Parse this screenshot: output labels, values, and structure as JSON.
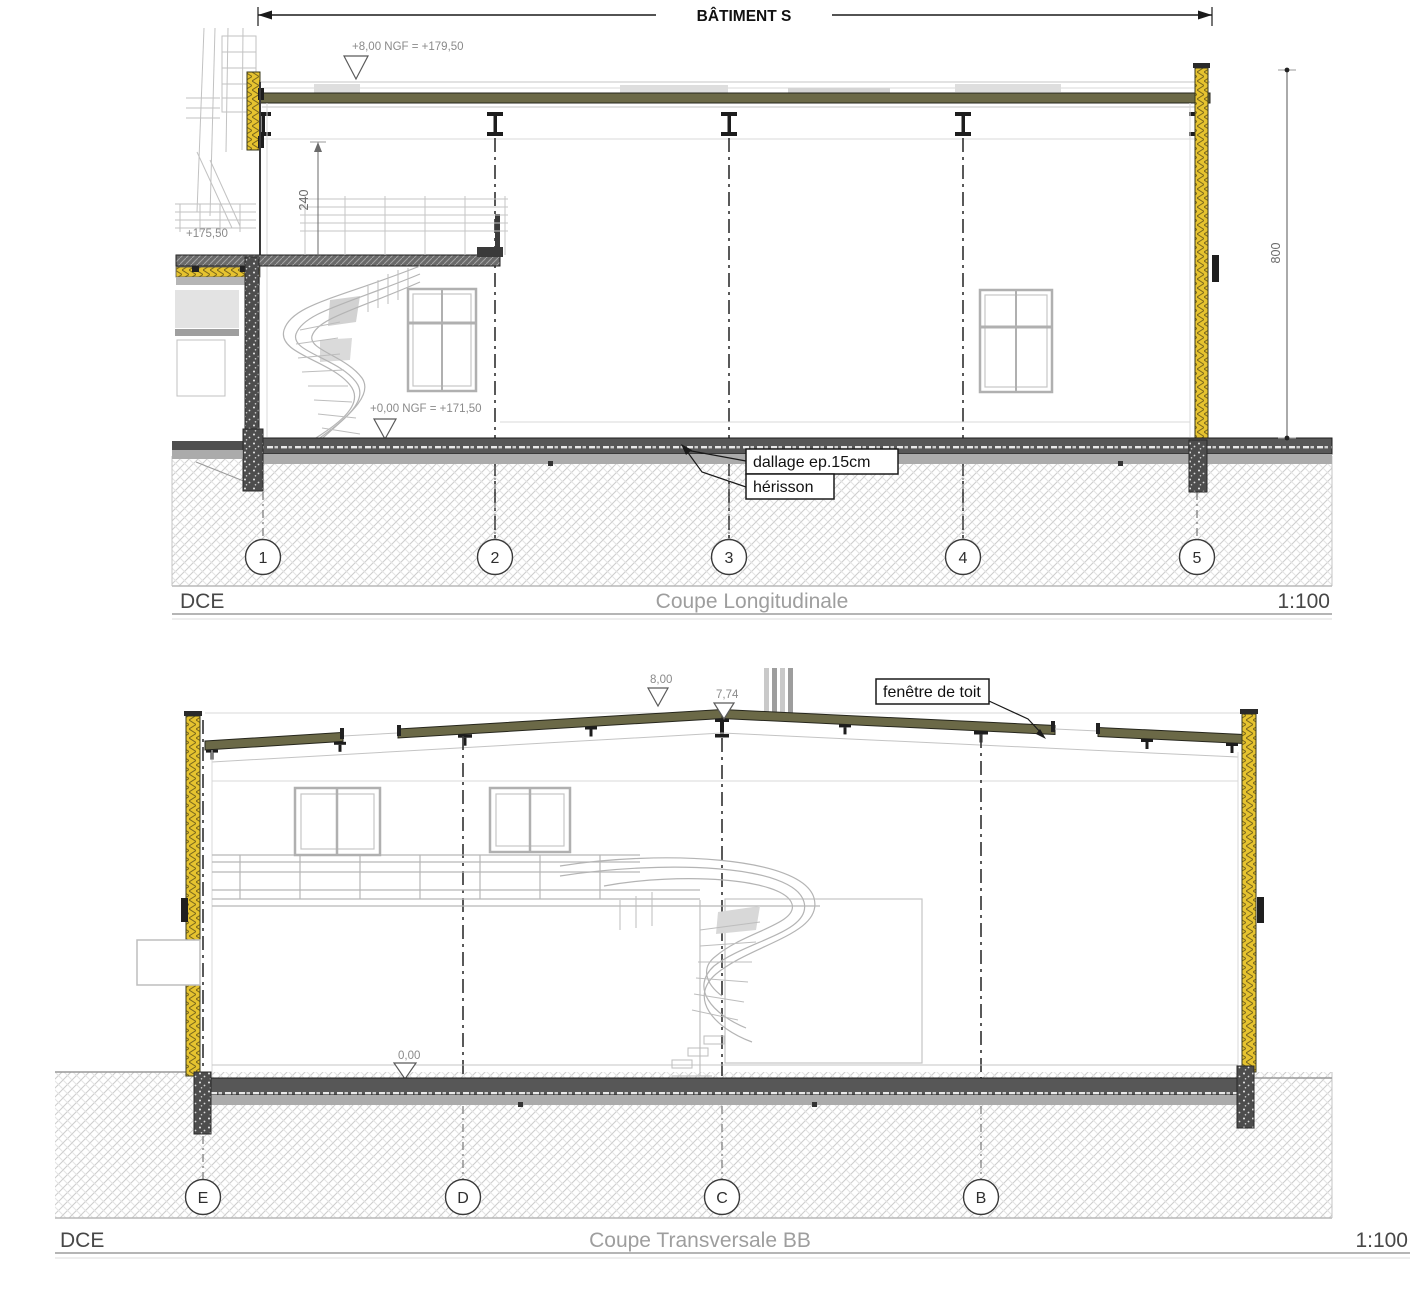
{
  "top_section": {
    "dim_building": "BÂTIMENT S",
    "level_roof": "+8,00 NGF = +179,50",
    "level_mezzanine": "+175,50",
    "dim_mezzanine_height": "240",
    "level_ground": "+0,00 NGF = +171,50",
    "dim_total_height": "800",
    "label_dallage": "dallage ep.15cm",
    "label_herisson": "hérisson",
    "grids": [
      "1",
      "2",
      "3",
      "4",
      "5"
    ],
    "title": {
      "phase": "DCE",
      "name": "Coupe Longitudinale",
      "scale": "1:100"
    }
  },
  "bottom_section": {
    "level_ridge_a": "8,00",
    "level_ridge_b": "7,74",
    "label_roof_window": "fenêtre de toit",
    "level_ground": "0,00",
    "grids": [
      "E",
      "D",
      "C",
      "B"
    ],
    "title": {
      "phase": "DCE",
      "name": "Coupe Transversale BB",
      "scale": "1:100"
    }
  },
  "colors": {
    "roof_band": "#6b6947",
    "insulation_yellow": "#e6c32f",
    "slab_dark": "#575757",
    "underlay_gray": "#ababab",
    "foundation_dark": "#4d4d4d",
    "ground_hatch": "#cdcdcd",
    "light_line": "#c4c4c4",
    "dark_line": "#2a2a2a",
    "title_gray": "#9e9e9e"
  }
}
